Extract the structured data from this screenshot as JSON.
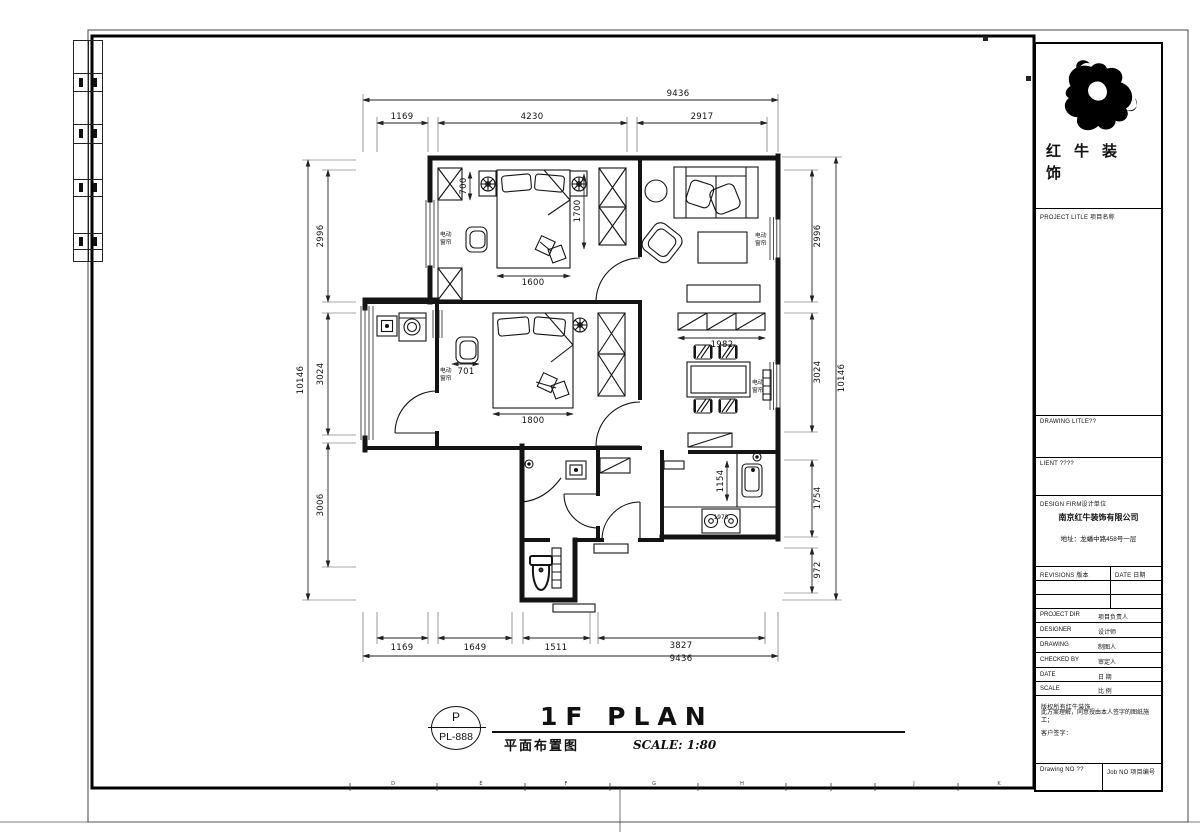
{
  "sheet": {
    "grid_letters": [
      "D",
      "E",
      "F",
      "G",
      "H",
      "J",
      "K"
    ]
  },
  "plan": {
    "curtain": {
      "l1": "电动",
      "l2": "窗帘"
    },
    "dims": {
      "top_overall": "9436",
      "top_a": "1169",
      "top_b": "4230",
      "top_c": "2917",
      "left_overall": "10146",
      "left_a": "2996",
      "left_b": "3024",
      "left_c": "3006",
      "right_a": "2996",
      "right_b": "3024",
      "right_c": "1754",
      "right_d": "972",
      "right_overall": "10146",
      "bot_a": "1169",
      "bot_b": "1649",
      "bot_c": "1511",
      "bot_d": "3827",
      "bot_overall": "9436",
      "bed1_w": "1600",
      "bed1_side": "1700",
      "bed1_top": "700",
      "bed2_w": "1800",
      "bed2_chair": "701",
      "sideboard": "1982",
      "sink": "1154",
      "stove": "1978"
    }
  },
  "titlebar": {
    "marker_top": "P",
    "marker_bottom": "PL-888",
    "name_en": "1F PLAN",
    "name_zh": "平面布置图",
    "scale": "SCALE: 1:80"
  },
  "tb": {
    "logo_line1": "红牛装",
    "logo_line2": "饰",
    "project_label": "PROJECT LITLE 项目名称",
    "drawing_label": "DRAWING LITLE??",
    "client_label": "LIENT ????",
    "firm_label": "DESIGN FIRM设计单位",
    "firm_name": "南京红牛装饰有限公司",
    "firm_address": "地址：龙蟠中路458号一层",
    "revisions_label": "REVISIONS 版本",
    "date_label": "DATE 日期",
    "rows": [
      {
        "en": "PROJECT DIR",
        "zh": "项目负责人"
      },
      {
        "en": "DESIGNER",
        "zh": "设计师"
      },
      {
        "en": "DRAWING",
        "zh": "制图人"
      },
      {
        "en": "CHECKED BY",
        "zh": "审定人"
      },
      {
        "en": "DATE",
        "zh": "日 期"
      },
      {
        "en": "SCALE",
        "zh": "比 例"
      }
    ],
    "note1": "版权所有红牛装饰",
    "note2": "此方案理解，同意授由本人签字的图纸施工；",
    "note3": "客户签字：",
    "drawing_no": "Drawing NO ??",
    "job_no": "Job NO 项目编号"
  }
}
